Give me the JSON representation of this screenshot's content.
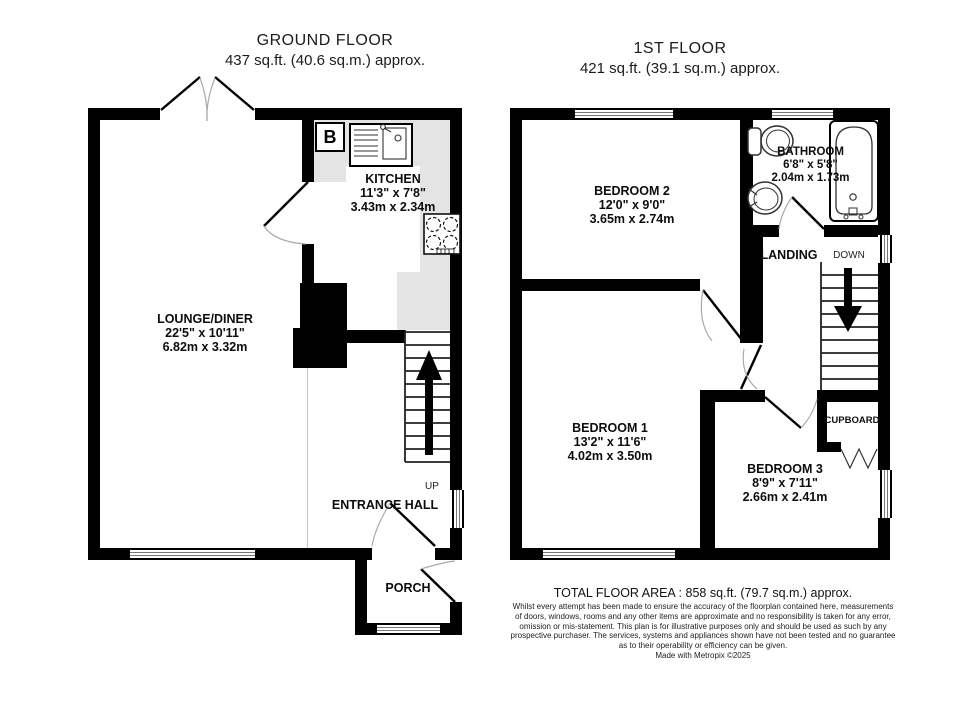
{
  "ground_floor": {
    "title": "GROUND FLOOR",
    "area": "437 sq.ft. (40.6 sq.m.) approx.",
    "rooms": {
      "kitchen": {
        "name": "KITCHEN",
        "imperial": "11'3\" x 7'8\"",
        "metric": "3.43m x 2.34m"
      },
      "lounge": {
        "name": "LOUNGE/DINER",
        "imperial": "22'5\" x 10'11\"",
        "metric": "6.82m x 3.32m"
      },
      "entrance_hall": {
        "name": "ENTRANCE HALL"
      },
      "porch": {
        "name": "PORCH"
      }
    },
    "labels": {
      "up": "UP",
      "boiler": "B"
    }
  },
  "first_floor": {
    "title": "1ST FLOOR",
    "area": "421 sq.ft. (39.1 sq.m.) approx.",
    "rooms": {
      "bedroom2": {
        "name": "BEDROOM 2",
        "imperial": "12'0\" x 9'0\"",
        "metric": "3.65m x 2.74m"
      },
      "bathroom": {
        "name": "BATHROOM",
        "imperial": "6'8\" x 5'8\"",
        "metric": "2.04m x 1.73m"
      },
      "bedroom1": {
        "name": "BEDROOM 1",
        "imperial": "13'2\" x 11'6\"",
        "metric": "4.02m x 3.50m"
      },
      "bedroom3": {
        "name": "BEDROOM 3",
        "imperial": "8'9\" x 7'11\"",
        "metric": "2.66m x 2.41m"
      },
      "landing": {
        "name": "LANDING"
      },
      "cupboard": {
        "name": "CUPBOARD"
      }
    },
    "labels": {
      "down": "DOWN"
    }
  },
  "footer": {
    "total_area": "TOTAL FLOOR AREA : 858 sq.ft. (79.7 sq.m.) approx.",
    "disclaimer_lines": [
      "Whilst every attempt has been made to ensure the accuracy of the floorplan contained here, measurements",
      "of doors, windows, rooms and any other items are approximate and no responsibility is taken for any error,",
      "omission or mis-statement. This plan is for illustrative purposes only and should be used as such by any",
      "prospective purchaser. The services, systems and appliances shown have not been tested and no guarantee",
      "as to their operability or efficiency can be given."
    ],
    "credit": "Made with Metropix ©2025"
  },
  "colors": {
    "wall": "#000000",
    "counter": "#e4e4e4",
    "window_line": "#777777"
  }
}
